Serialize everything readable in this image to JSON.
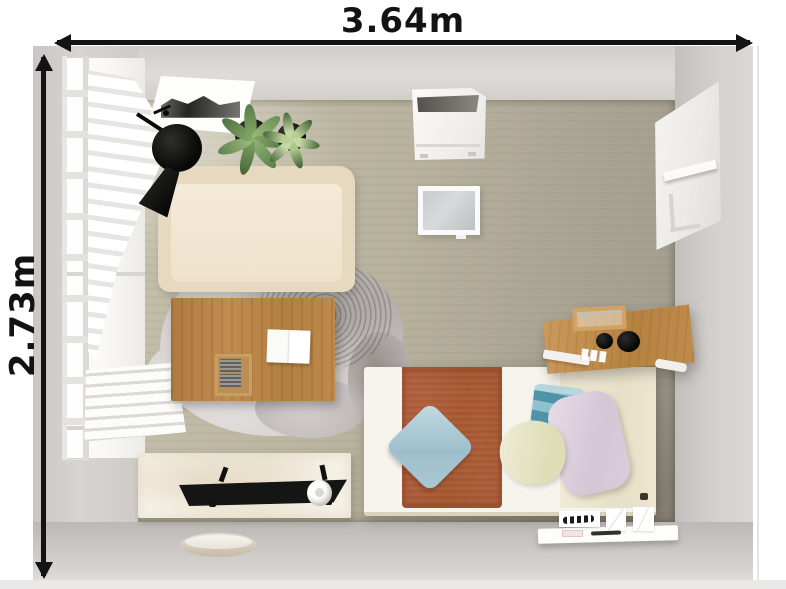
{
  "scene": {
    "kind": "top-down-room-render",
    "room_width_m": 3.64,
    "room_depth_m": 2.73
  },
  "dimensions": {
    "width_label": "3.64m",
    "height_label": "2.73m"
  },
  "palette": {
    "annotation_black": "#131313",
    "wall_gray": "#d2cfcc",
    "floor_beige": "#b5b09c",
    "sofa_cream": "#eee2cc",
    "wood": "#b9854a",
    "rug_gray": "#c6c0be",
    "terracotta": "#ab5c36",
    "pillow_blue": "#a9c8d3",
    "pillow_teal": "#5d9db0",
    "pillow_sage": "#e5e2c0",
    "pillow_lavender": "#d9cdda",
    "lamp_black": "#141414",
    "plant_green": "#6e945a"
  },
  "furniture": [
    {
      "name": "window",
      "color": "#ffffff"
    },
    {
      "name": "roman-shade-curtain",
      "color": "#f2f1ee"
    },
    {
      "name": "folded-curtain-stack",
      "color": "#f7f6f4"
    },
    {
      "name": "wall-art-frame",
      "color": "#ffffff"
    },
    {
      "name": "potted-plant-large",
      "color": "#6e945a"
    },
    {
      "name": "potted-plant-small",
      "color": "#7fa065"
    },
    {
      "name": "black-floor-lamp",
      "color": "#141414"
    },
    {
      "name": "cream-sofa",
      "color": "#eee2cc"
    },
    {
      "name": "sheepskin-rug",
      "color": "#c6c0be"
    },
    {
      "name": "wooden-desk",
      "color": "#b5824a"
    },
    {
      "name": "open-notebook",
      "color": "#fbfbfa"
    },
    {
      "name": "desk-organizer-tray",
      "color": "#c79d60"
    },
    {
      "name": "white-console-table",
      "color": "#f4efe3"
    },
    {
      "name": "black-chair",
      "color": "#1a1a1a"
    },
    {
      "name": "white-mug",
      "color": "#ffffff"
    },
    {
      "name": "round-floor-tray",
      "color": "#d8cdbd"
    },
    {
      "name": "bed",
      "color": "#f6f3ec"
    },
    {
      "name": "terracotta-bed-runner",
      "color": "#ab5c36"
    },
    {
      "name": "blue-pillow",
      "color": "#a9c8d3"
    },
    {
      "name": "striped-teal-pillow",
      "color": "#5d9db0"
    },
    {
      "name": "sage-pillow",
      "color": "#e5e2c0"
    },
    {
      "name": "lavender-pillow",
      "color": "#d9cdda"
    },
    {
      "name": "wooden-wall-shelf",
      "color": "#c08c50"
    },
    {
      "name": "black-bowls",
      "color": "#111111"
    },
    {
      "name": "white-wall-cabinet",
      "color": "#f5f4f2"
    },
    {
      "name": "wall-mirror",
      "color": "#c5c6c8"
    },
    {
      "name": "white-wardrobe-panel",
      "color": "#f1f0ee"
    },
    {
      "name": "white-floating-shelf",
      "color": "#fcfcfb"
    }
  ]
}
